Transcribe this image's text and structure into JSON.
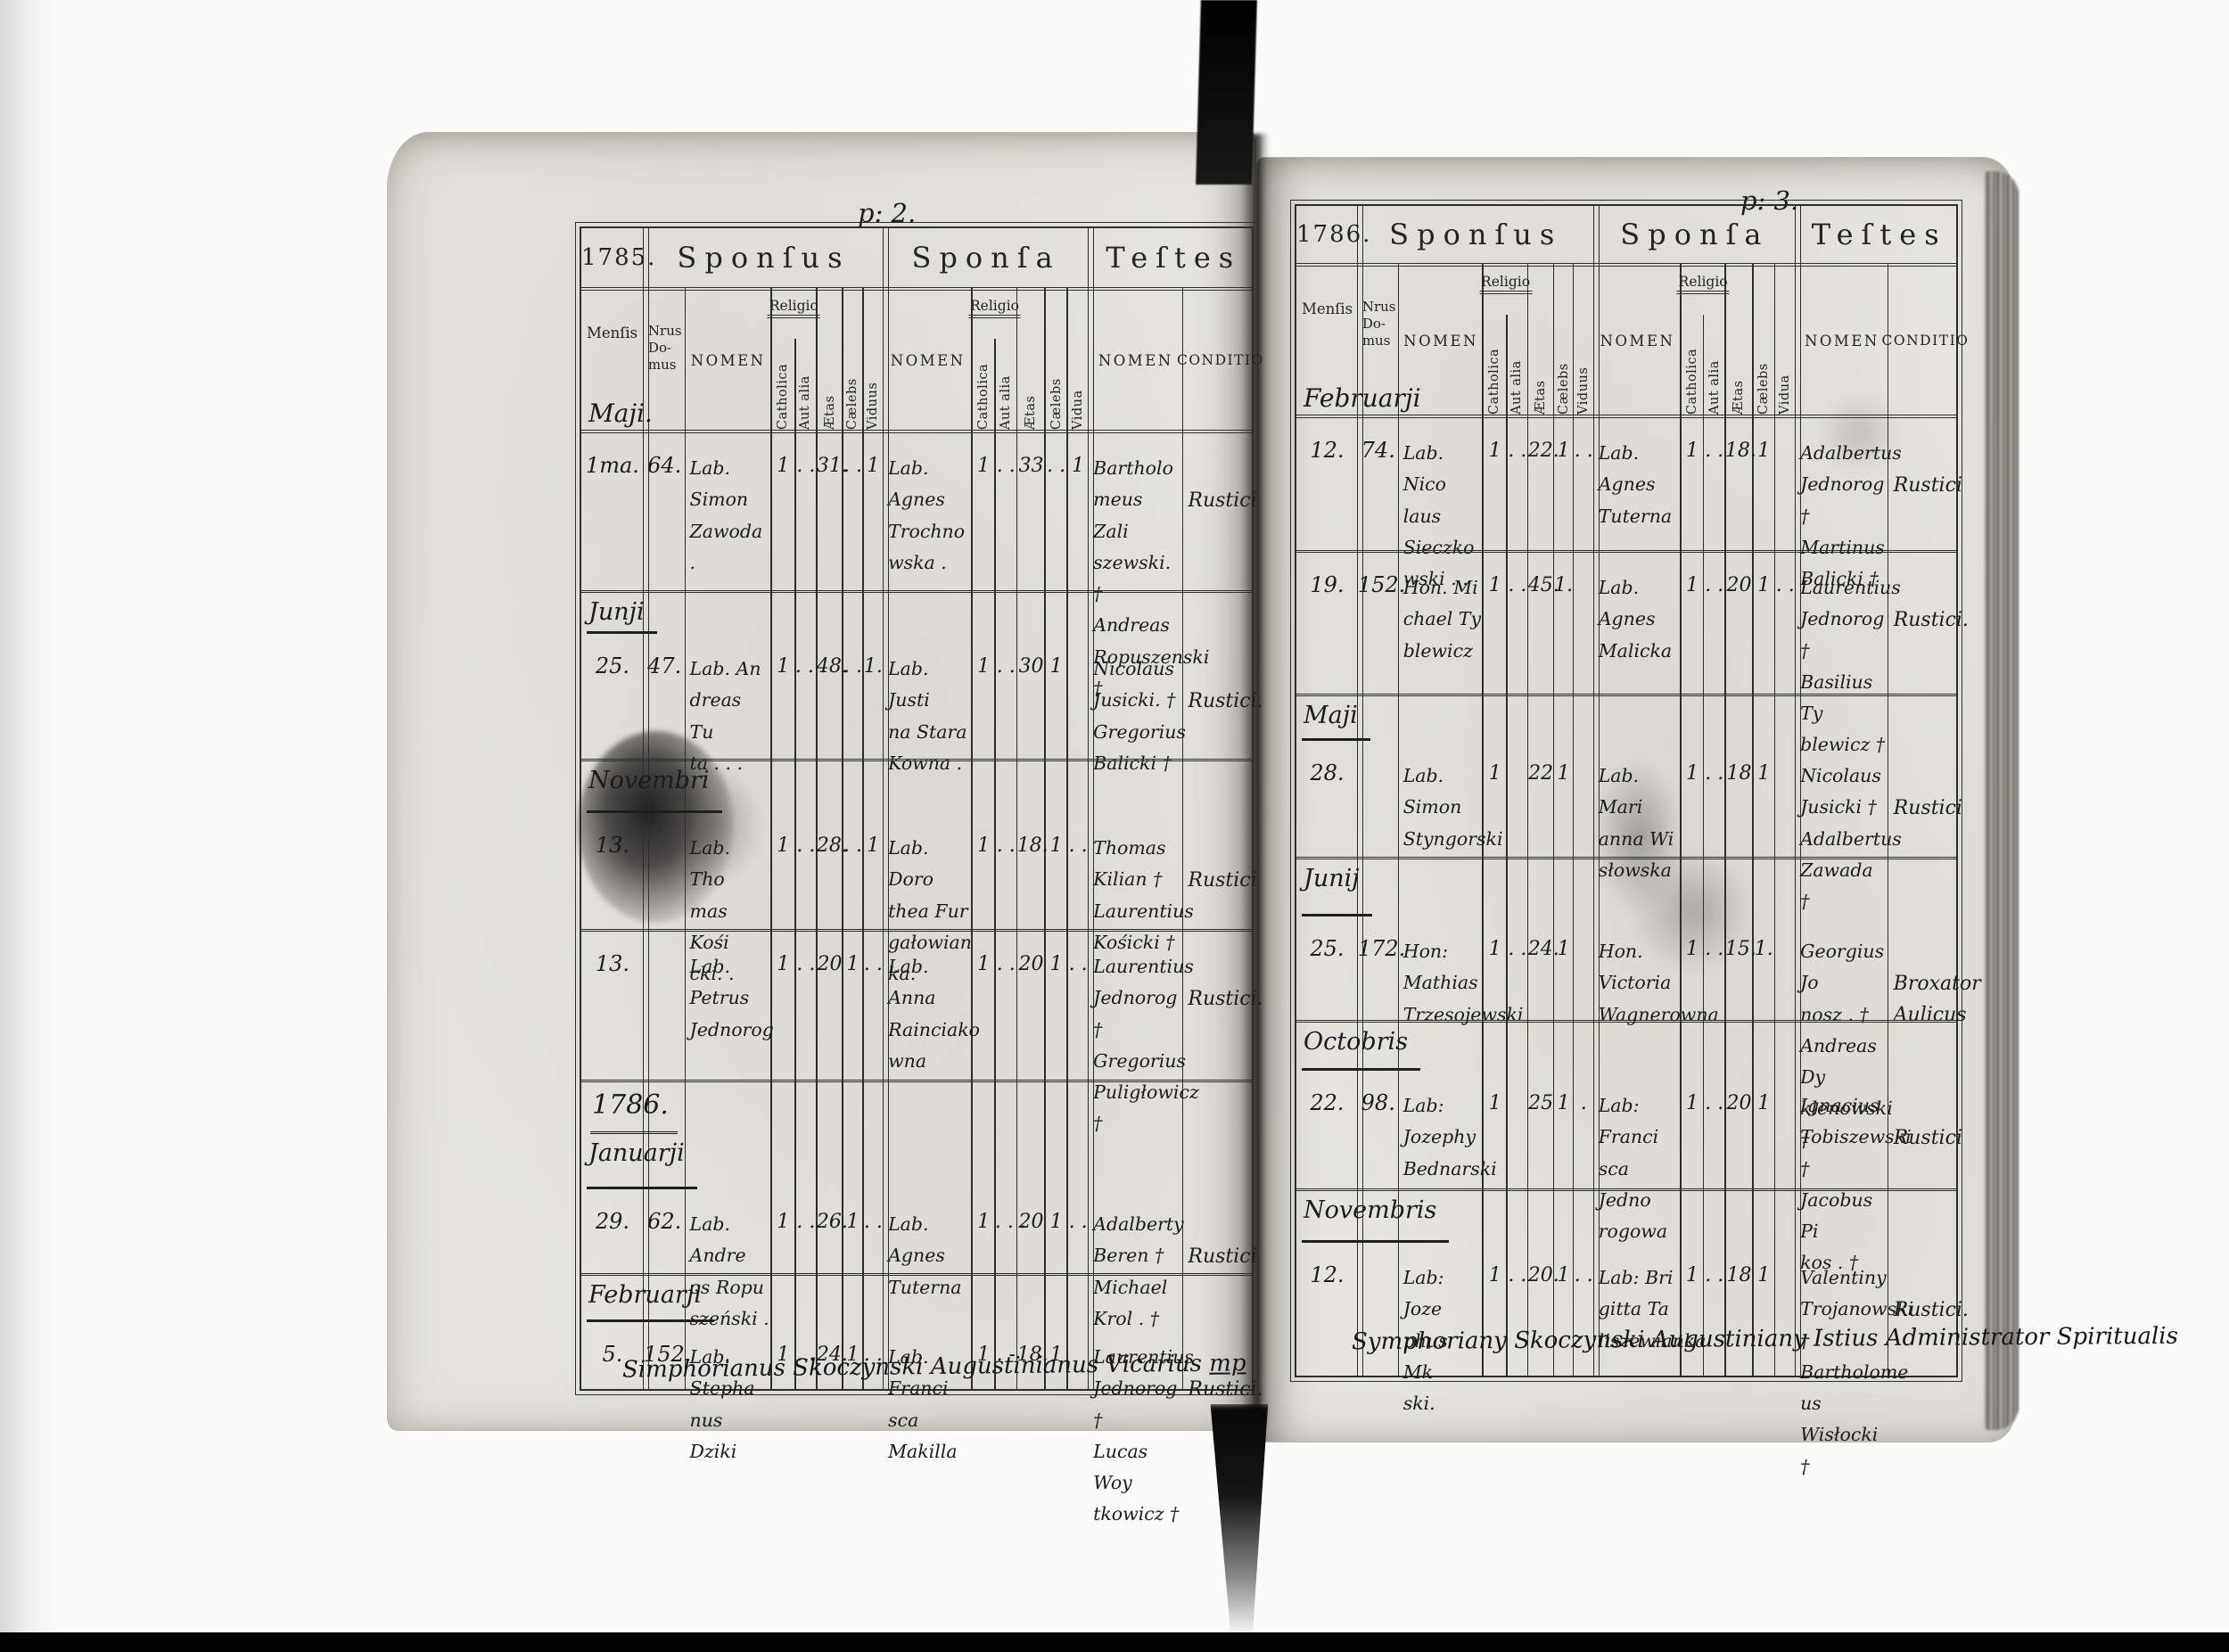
{
  "labels": {
    "sponsus": "Sponſus",
    "sponsa": "Sponſa",
    "testes": "Teſtes",
    "mensis": "Menſis",
    "nrus_domus": "Nrus\nDo-\nmus",
    "nomen": "NOMEN",
    "religio": "Religio",
    "catholica": "Catholica",
    "aut_alia": "Aut alia",
    "aetas": "Ætas",
    "caelebs": "Cælebs",
    "viduus": "Viduus",
    "vidua": "Vidua",
    "conditio": "CONDITIO"
  },
  "left": {
    "page_no": "p: 2.",
    "year": "1785.",
    "header_month": "Maji.",
    "footer": "Simphorianus Skoczynski Augustinianus Vicarius",
    "footer_mark": "mp",
    "rows": [
      {
        "type": "record",
        "day": "1ma.",
        "house": "64.",
        "sponsus": {
          "name": "Lab. Simon\nZawoda .",
          "cath": "1",
          "aut": ". .",
          "aetas": "31.",
          "cael": ". .",
          "vid": "1"
        },
        "sponsa": {
          "name": "Lab. Agnes\nTrochno\nwska .",
          "cath": "1",
          "aut": ". .",
          "aetas": "33",
          "cael": ". .",
          "vid": "1"
        },
        "testes": "Bartholo\nmeus Zali\nszewski. †\nAndreas\nRopuszenski †",
        "conditio": "Rustici"
      },
      {
        "type": "month",
        "label": "Junji"
      },
      {
        "type": "record",
        "day": "25.",
        "house": "47.",
        "sponsus": {
          "name": "Lab. An\ndreas Tu\nta . . .",
          "cath": "1",
          "aut": ". . .",
          "aetas": "48.",
          "cael": ". .",
          "vid": "1."
        },
        "sponsa": {
          "name": "Lab. Justi\nna Stara\nKowna .",
          "cath": "1",
          "aut": ". .",
          "aetas": "30",
          "cael": "1",
          "vid": ""
        },
        "testes": "Nicolaus\nJusicki. †\nGregorius\nBalicki †",
        "conditio": "Rustici."
      },
      {
        "type": "month",
        "label": "Novembri"
      },
      {
        "type": "record",
        "day": "13.",
        "house": "",
        "sponsus": {
          "name": "Lab. Tho\nmas Kośi\ncki. .",
          "cath": "1",
          "aut": ". .",
          "aetas": "28.",
          "cael": ". .",
          "vid": "1"
        },
        "sponsa": {
          "name": "Lab. Doro\nthea Fur\ngałowian\nka.",
          "cath": "1",
          "aut": ". .",
          "aetas": "18.",
          "cael": "1",
          "vid": ". ."
        },
        "testes": "Thomas\nKilian †\nLaurentius\nKośicki †",
        "conditio": "Rustici"
      },
      {
        "type": "record",
        "day": "13.",
        "house": "",
        "sponsus": {
          "name": "Lab. Petrus\nJednorog",
          "cath": "1",
          "aut": ". .",
          "aetas": "20",
          "cael": "1",
          "vid": ". ."
        },
        "sponsa": {
          "name": "Lab. Anna\nRainciako\nwna",
          "cath": "1",
          "aut": ". .",
          "aetas": "20",
          "cael": "1",
          "vid": ". ."
        },
        "testes": "Laurentius\nJednorog †\nGregorius\nPuligłowicz †",
        "conditio": "Rustici."
      },
      {
        "type": "year",
        "label": "1786."
      },
      {
        "type": "month",
        "label": "Januarji"
      },
      {
        "type": "record",
        "day": "29.",
        "house": "62.",
        "sponsus": {
          "name": "Lab. Andre\nos Ropu\nszeński .",
          "cath": "1",
          "aut": ". .",
          "aetas": "26.",
          "cael": "1",
          "vid": ". ."
        },
        "sponsa": {
          "name": "Lab. Agnes\nTuterna",
          "cath": "1",
          "aut": ". . .",
          "aetas": "20",
          "cael": "1",
          "vid": ". ."
        },
        "testes": "Adalberty\nBeren †\nMichael\nKrol . †",
        "conditio": "Rustici"
      },
      {
        "type": "month",
        "label": "Februarji"
      },
      {
        "type": "record",
        "day": "5.",
        "house": "152.",
        "sponsus": {
          "name": "Lab. Stepha\nnus Dziki",
          "cath": "1",
          "aut": ". .",
          "aetas": "24.",
          "cael": "1",
          "vid": ". ."
        },
        "sponsa": {
          "name": "Lab. Franci\nsca Makilla",
          "cath": "1",
          "aut": ". -",
          "aetas": "18.",
          "cael": "1",
          "vid": ""
        },
        "testes": "Laurentius\nJednorog †\nLucas Woy\ntkowicz †",
        "conditio": "Rustici."
      }
    ]
  },
  "right": {
    "page_no": "p: 3.",
    "year": "1786.",
    "header_month": "Februarji",
    "footer": "Symphoriany Skoczynski Augustiniany Istius Administrator Spiritualis",
    "footer_mark": "",
    "rows": [
      {
        "type": "record",
        "day": "12.",
        "house": "74.",
        "sponsus": {
          "name": "Lab. Nico\nlaus Sieczko\nwski . .",
          "cath": "1",
          "aut": ". .",
          "aetas": "22.",
          "cael": "1",
          "vid": ". ."
        },
        "sponsa": {
          "name": "Lab. Agnes\nTuterna",
          "cath": "1",
          "aut": ". .",
          "aetas": "18.",
          "cael": "1",
          "vid": ""
        },
        "testes": "Adalbertus\nJednorog †\nMartinus\nBalicki †",
        "conditio": "Rustici"
      },
      {
        "type": "record",
        "day": "19.",
        "house": "152.",
        "sponsus": {
          "name": "Hon. Mi\nchael Ty\nblewicz",
          "cath": "1",
          "aut": ". .",
          "aetas": "45.",
          "cael": "1.",
          "vid": ""
        },
        "sponsa": {
          "name": "Lab. Agnes\nMalicka",
          "cath": "1",
          "aut": ". .",
          "aetas": "20",
          "cael": "1",
          "vid": ". ."
        },
        "testes": "Laurentius\nJednorog †\nBasilius Ty\nblewicz †",
        "conditio": "Rustici."
      },
      {
        "type": "month",
        "label": "Maji"
      },
      {
        "type": "record",
        "day": "28.",
        "house": "",
        "sponsus": {
          "name": "Lab. Simon\nStyngorski",
          "cath": "1",
          "aut": "",
          "aetas": "22",
          "cael": "1",
          "vid": ""
        },
        "sponsa": {
          "name": "Lab. Mari\nanna Wi\nsłowska",
          "cath": "1",
          "aut": ". .",
          "aetas": "18",
          "cael": "1",
          "vid": ""
        },
        "testes": "Nicolaus\nJusicki †\nAdalbertus\nZawada †",
        "conditio": "Rustici"
      },
      {
        "type": "month",
        "label": "Junij"
      },
      {
        "type": "record",
        "day": "25.",
        "house": "172.",
        "sponsus": {
          "name": "Hon: Mathias\nTrzesojewski",
          "cath": "1",
          "aut": ". .",
          "aetas": "24.",
          "cael": "1",
          "vid": ""
        },
        "sponsa": {
          "name": "Hon. Victoria\nWagnerowna",
          "cath": "1",
          "aut": ". .",
          "aetas": "15.",
          "cael": "1.",
          "vid": ""
        },
        "testes": "Georgius Jo\nnosz . †\nAndreas Dy\nklenowski †",
        "conditio": "Broxator\nAulicus"
      },
      {
        "type": "month",
        "label": "Octobris"
      },
      {
        "type": "record",
        "day": "22.",
        "house": "98.",
        "sponsus": {
          "name": "Lab: Jozephy\nBednarski",
          "cath": "1",
          "aut": "",
          "aetas": "25",
          "cael": "1",
          "vid": "."
        },
        "sponsa": {
          "name": "Lab: Franci\nsca Jedno\nrogowa",
          "cath": "1",
          "aut": ". .",
          "aetas": "20",
          "cael": "1",
          "vid": ""
        },
        "testes": "Ignacius\nTobiszewski †\nJacobus Pi\nkos . †",
        "conditio": "Rustici"
      },
      {
        "type": "month",
        "label": "Novembris"
      },
      {
        "type": "record",
        "day": "12.",
        "house": "",
        "sponsus": {
          "name": "Lab: Joze\nphus Mk\nski.",
          "cath": "1",
          "aut": ". .",
          "aetas": "20.",
          "cael": "1",
          "vid": ". ."
        },
        "sponsa": {
          "name": "Lab: Bri\ngitta Ta\nliszewianka",
          "cath": "1",
          "aut": ". .",
          "aetas": "18",
          "cael": "1",
          "vid": ""
        },
        "testes": "Valentiny\nTrojanowski †\nBartholome\nus Wisłocki †",
        "conditio": "Rustici."
      }
    ]
  }
}
